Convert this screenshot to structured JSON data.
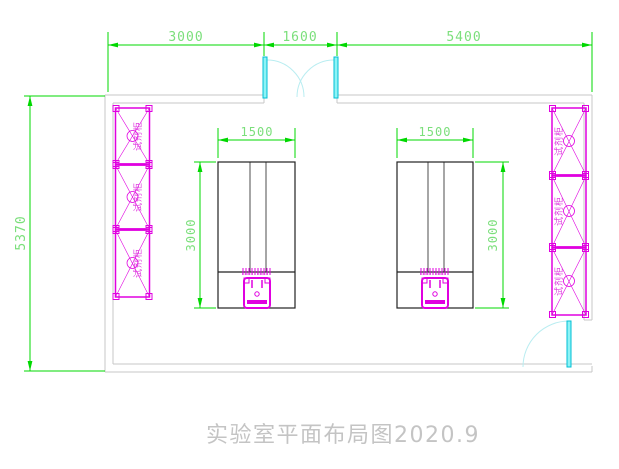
{
  "drawing": {
    "title": "实验室平面布局图2020.9",
    "dims": {
      "top": [
        {
          "label": "3000"
        },
        {
          "label": "1600"
        },
        {
          "label": "5400"
        }
      ],
      "left": {
        "label": "5370"
      },
      "bench_width": {
        "label": "1500"
      },
      "bench_height": {
        "label": "3000"
      }
    },
    "cabinets": {
      "label": "试剂柜",
      "left_count": 3,
      "right_count": 3
    },
    "colors": {
      "dimension_line": "#00d800",
      "dimension_text": "#7bdf7b",
      "cabinet": "#e000e0",
      "door_leaf": "#8df3f6",
      "door_arc": "#b9edf1",
      "wall": "#c7c7c7",
      "bench_outline": "#222222",
      "title_text": "#c4c4c4"
    }
  }
}
